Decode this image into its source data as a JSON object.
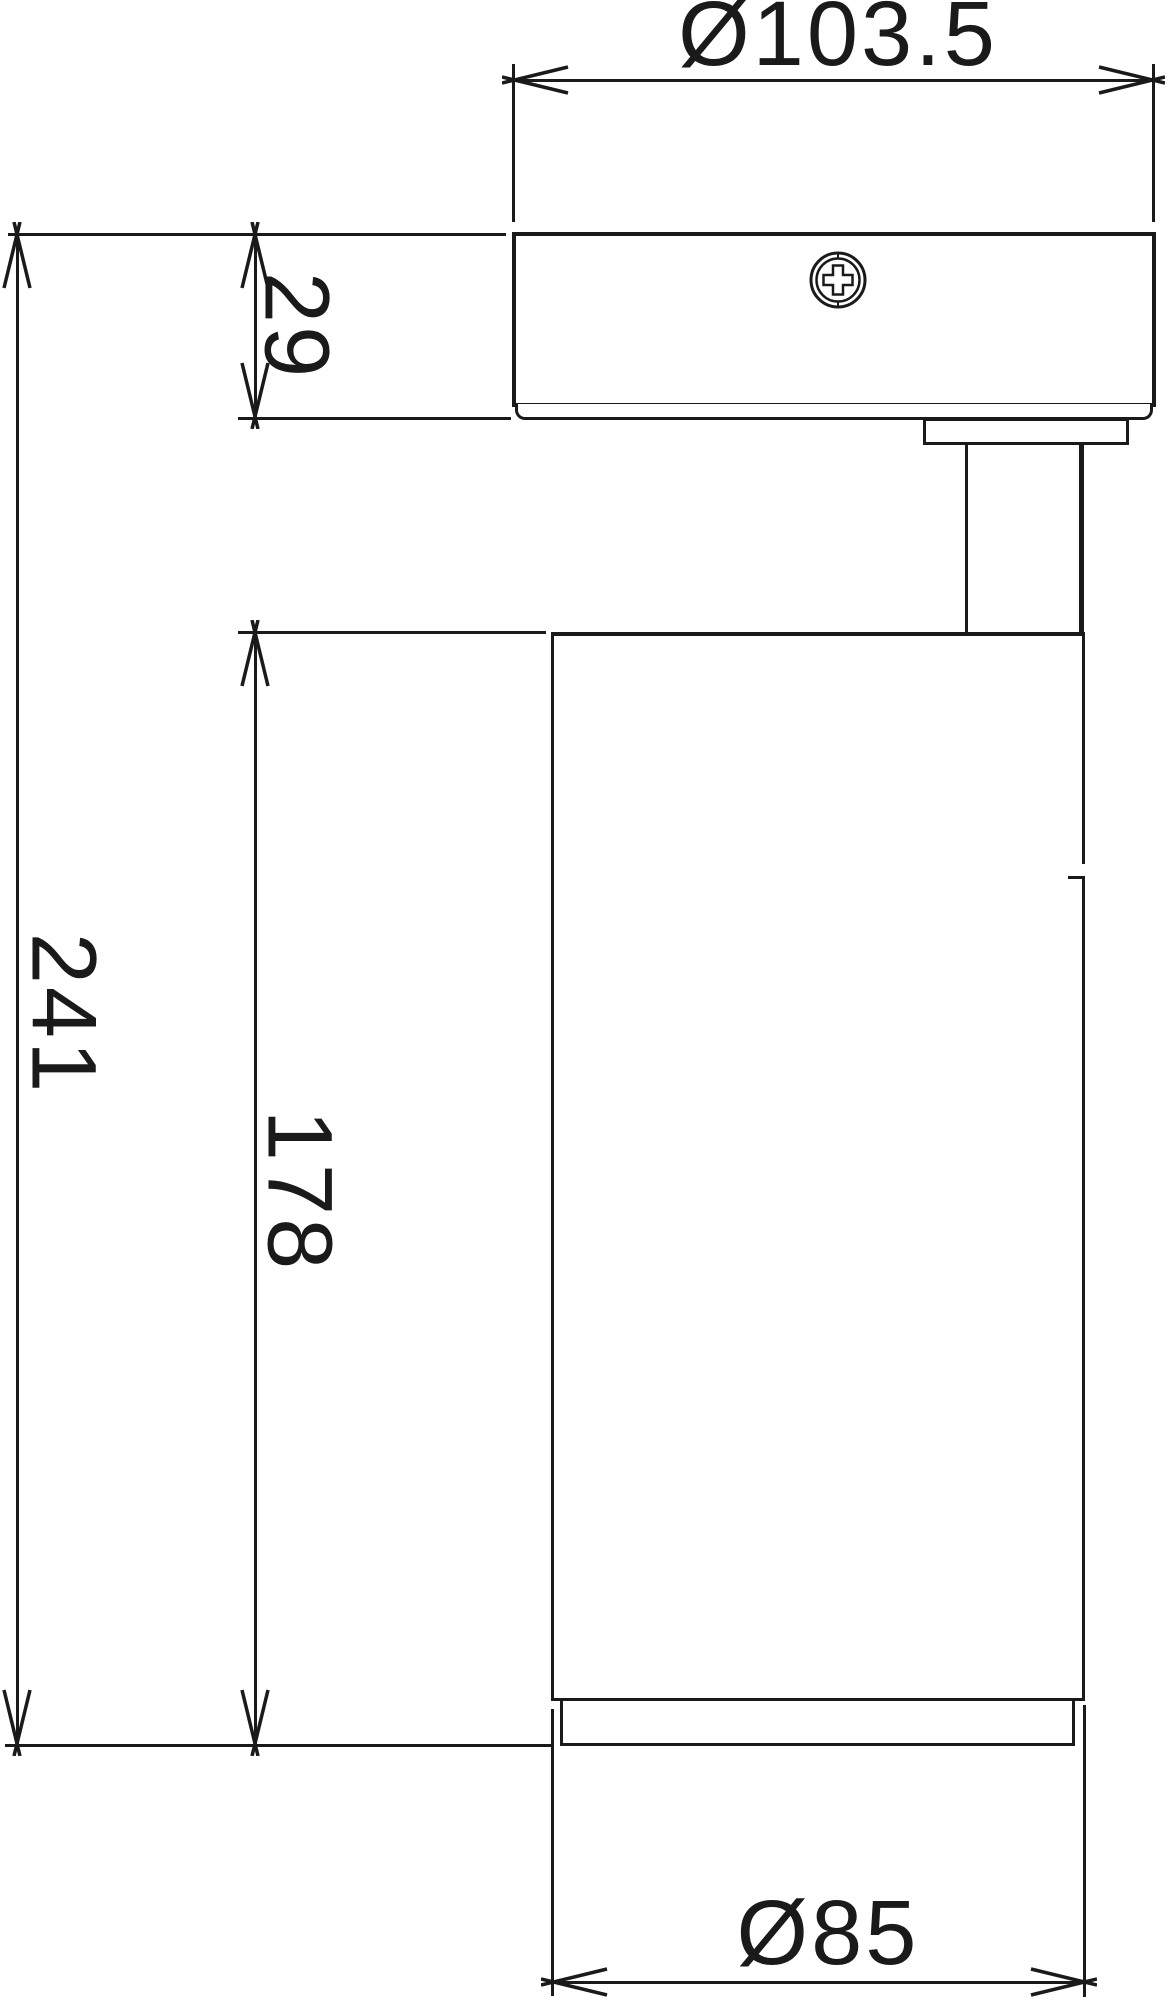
{
  "drawing": {
    "title": "spotlight-dimension-drawing",
    "subject": "ceiling spotlight side view with dimensions",
    "units": "mm",
    "line_color": "#1a1a1a",
    "background_color": "#ffffff",
    "dims": {
      "canopy_diameter": "Ø103.5",
      "canopy_height": "29",
      "overall_height": "241",
      "head_height": "178",
      "head_diameter": "Ø85"
    },
    "icons": {
      "screw": "phillips-screw-head-icon"
    }
  }
}
